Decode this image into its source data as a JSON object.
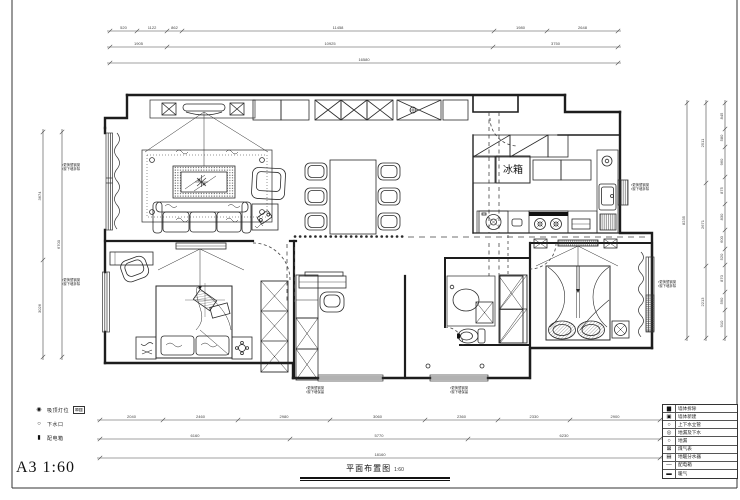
{
  "sheet": {
    "format_scale": "A3 1:60",
    "drawing_title": "平面布置图",
    "drawing_scale": "1:60"
  },
  "plan": {
    "fridge_label": "冰箱"
  },
  "legend_left": {
    "items": [
      {
        "symbol": "◉",
        "label": "吸顶灯位",
        "extra": "⊠▥"
      },
      {
        "symbol": "○",
        "label": "下水口",
        "extra": ""
      },
      {
        "symbol": "▮",
        "label": "配电箱",
        "extra": ""
      }
    ]
  },
  "legend_right": {
    "items": [
      {
        "symbol": "▆",
        "label": "墙体拆除"
      },
      {
        "symbol": "▣",
        "label": "墙体新建"
      },
      {
        "symbol": "○",
        "label": "上下水立管"
      },
      {
        "symbol": "◎",
        "label": "地漏及下水"
      },
      {
        "symbol": "○",
        "label": "地漏"
      },
      {
        "symbol": "⊠",
        "label": "煤气表"
      },
      {
        "symbol": "▤",
        "label": "地暖分水器"
      },
      {
        "symbol": "—",
        "label": "配电箱"
      },
      {
        "symbol": "▬",
        "label": "暖气"
      }
    ]
  },
  "annotations": [
    {
      "x": 62,
      "y": 166,
      "lines": [
        "▪更换塑钢窗",
        "▪窗下墙拆除"
      ]
    },
    {
      "x": 62,
      "y": 281,
      "lines": [
        "▪更换塑钢窗",
        "▪窗下墙拆除"
      ]
    },
    {
      "x": 631,
      "y": 186,
      "lines": [
        "▪更换塑钢窗",
        "▪窗下墙拆除"
      ]
    },
    {
      "x": 658,
      "y": 283,
      "lines": [
        "▪更换塑钢窗",
        "▪窗下墙拆除"
      ]
    },
    {
      "x": 306,
      "y": 389,
      "lines": [
        "▪更换塑钢窗",
        "▪窗下墙保留"
      ]
    },
    {
      "x": 450,
      "y": 389,
      "lines": [
        "▪更换塑钢窗",
        "▪窗下墙保留"
      ]
    }
  ],
  "dimensions": [
    {
      "o": "h",
      "pos": 31,
      "ticks": [
        110,
        137,
        167,
        182,
        494,
        547,
        618
      ],
      "labels": [
        "520",
        "1122",
        "862",
        "11458",
        "1980",
        "2648"
      ]
    },
    {
      "o": "h",
      "pos": 47,
      "ticks": [
        110,
        167,
        493,
        618
      ],
      "labels": [
        "1905",
        "10925",
        "3750"
      ]
    },
    {
      "o": "h",
      "pos": 63,
      "ticks": [
        110,
        618
      ],
      "labels": [
        "16580"
      ]
    },
    {
      "o": "v",
      "pos": 43,
      "ticks": [
        132,
        260,
        357
      ],
      "labels": [
        "3674",
        "3026"
      ]
    },
    {
      "o": "v",
      "pos": 62,
      "ticks": [
        132,
        357
      ],
      "labels": [
        "6700"
      ]
    },
    {
      "o": "v",
      "pos": 687,
      "ticks": [
        103,
        338
      ],
      "labels": [
        "8235"
      ]
    },
    {
      "o": "v",
      "pos": 706,
      "ticks": [
        103,
        183,
        266,
        338
      ],
      "labels": [
        "2511",
        "2671",
        "2213"
      ]
    },
    {
      "o": "v",
      "pos": 725,
      "ticks": [
        103,
        129,
        147,
        177,
        204,
        230,
        249,
        265,
        292,
        310,
        338
      ],
      "labels": [
        "845",
        "580",
        "960",
        "875",
        "830",
        "600",
        "520",
        "870",
        "590",
        "910"
      ]
    },
    {
      "o": "h",
      "pos": 420,
      "ticks": [
        100,
        163,
        238,
        330,
        425,
        498,
        570,
        660
      ],
      "labels": [
        "2040",
        "2460",
        "2980",
        "3060",
        "2360",
        "2330",
        "2900"
      ]
    },
    {
      "o": "h",
      "pos": 439,
      "ticks": [
        100,
        290,
        468,
        660
      ],
      "labels": [
        "6160",
        "5770",
        "6230"
      ]
    },
    {
      "o": "h",
      "pos": 458,
      "ticks": [
        100,
        660
      ],
      "labels": [
        "18160"
      ]
    }
  ],
  "colors": {
    "ink": "#222222",
    "dim": "#444444",
    "note": "#333333"
  }
}
